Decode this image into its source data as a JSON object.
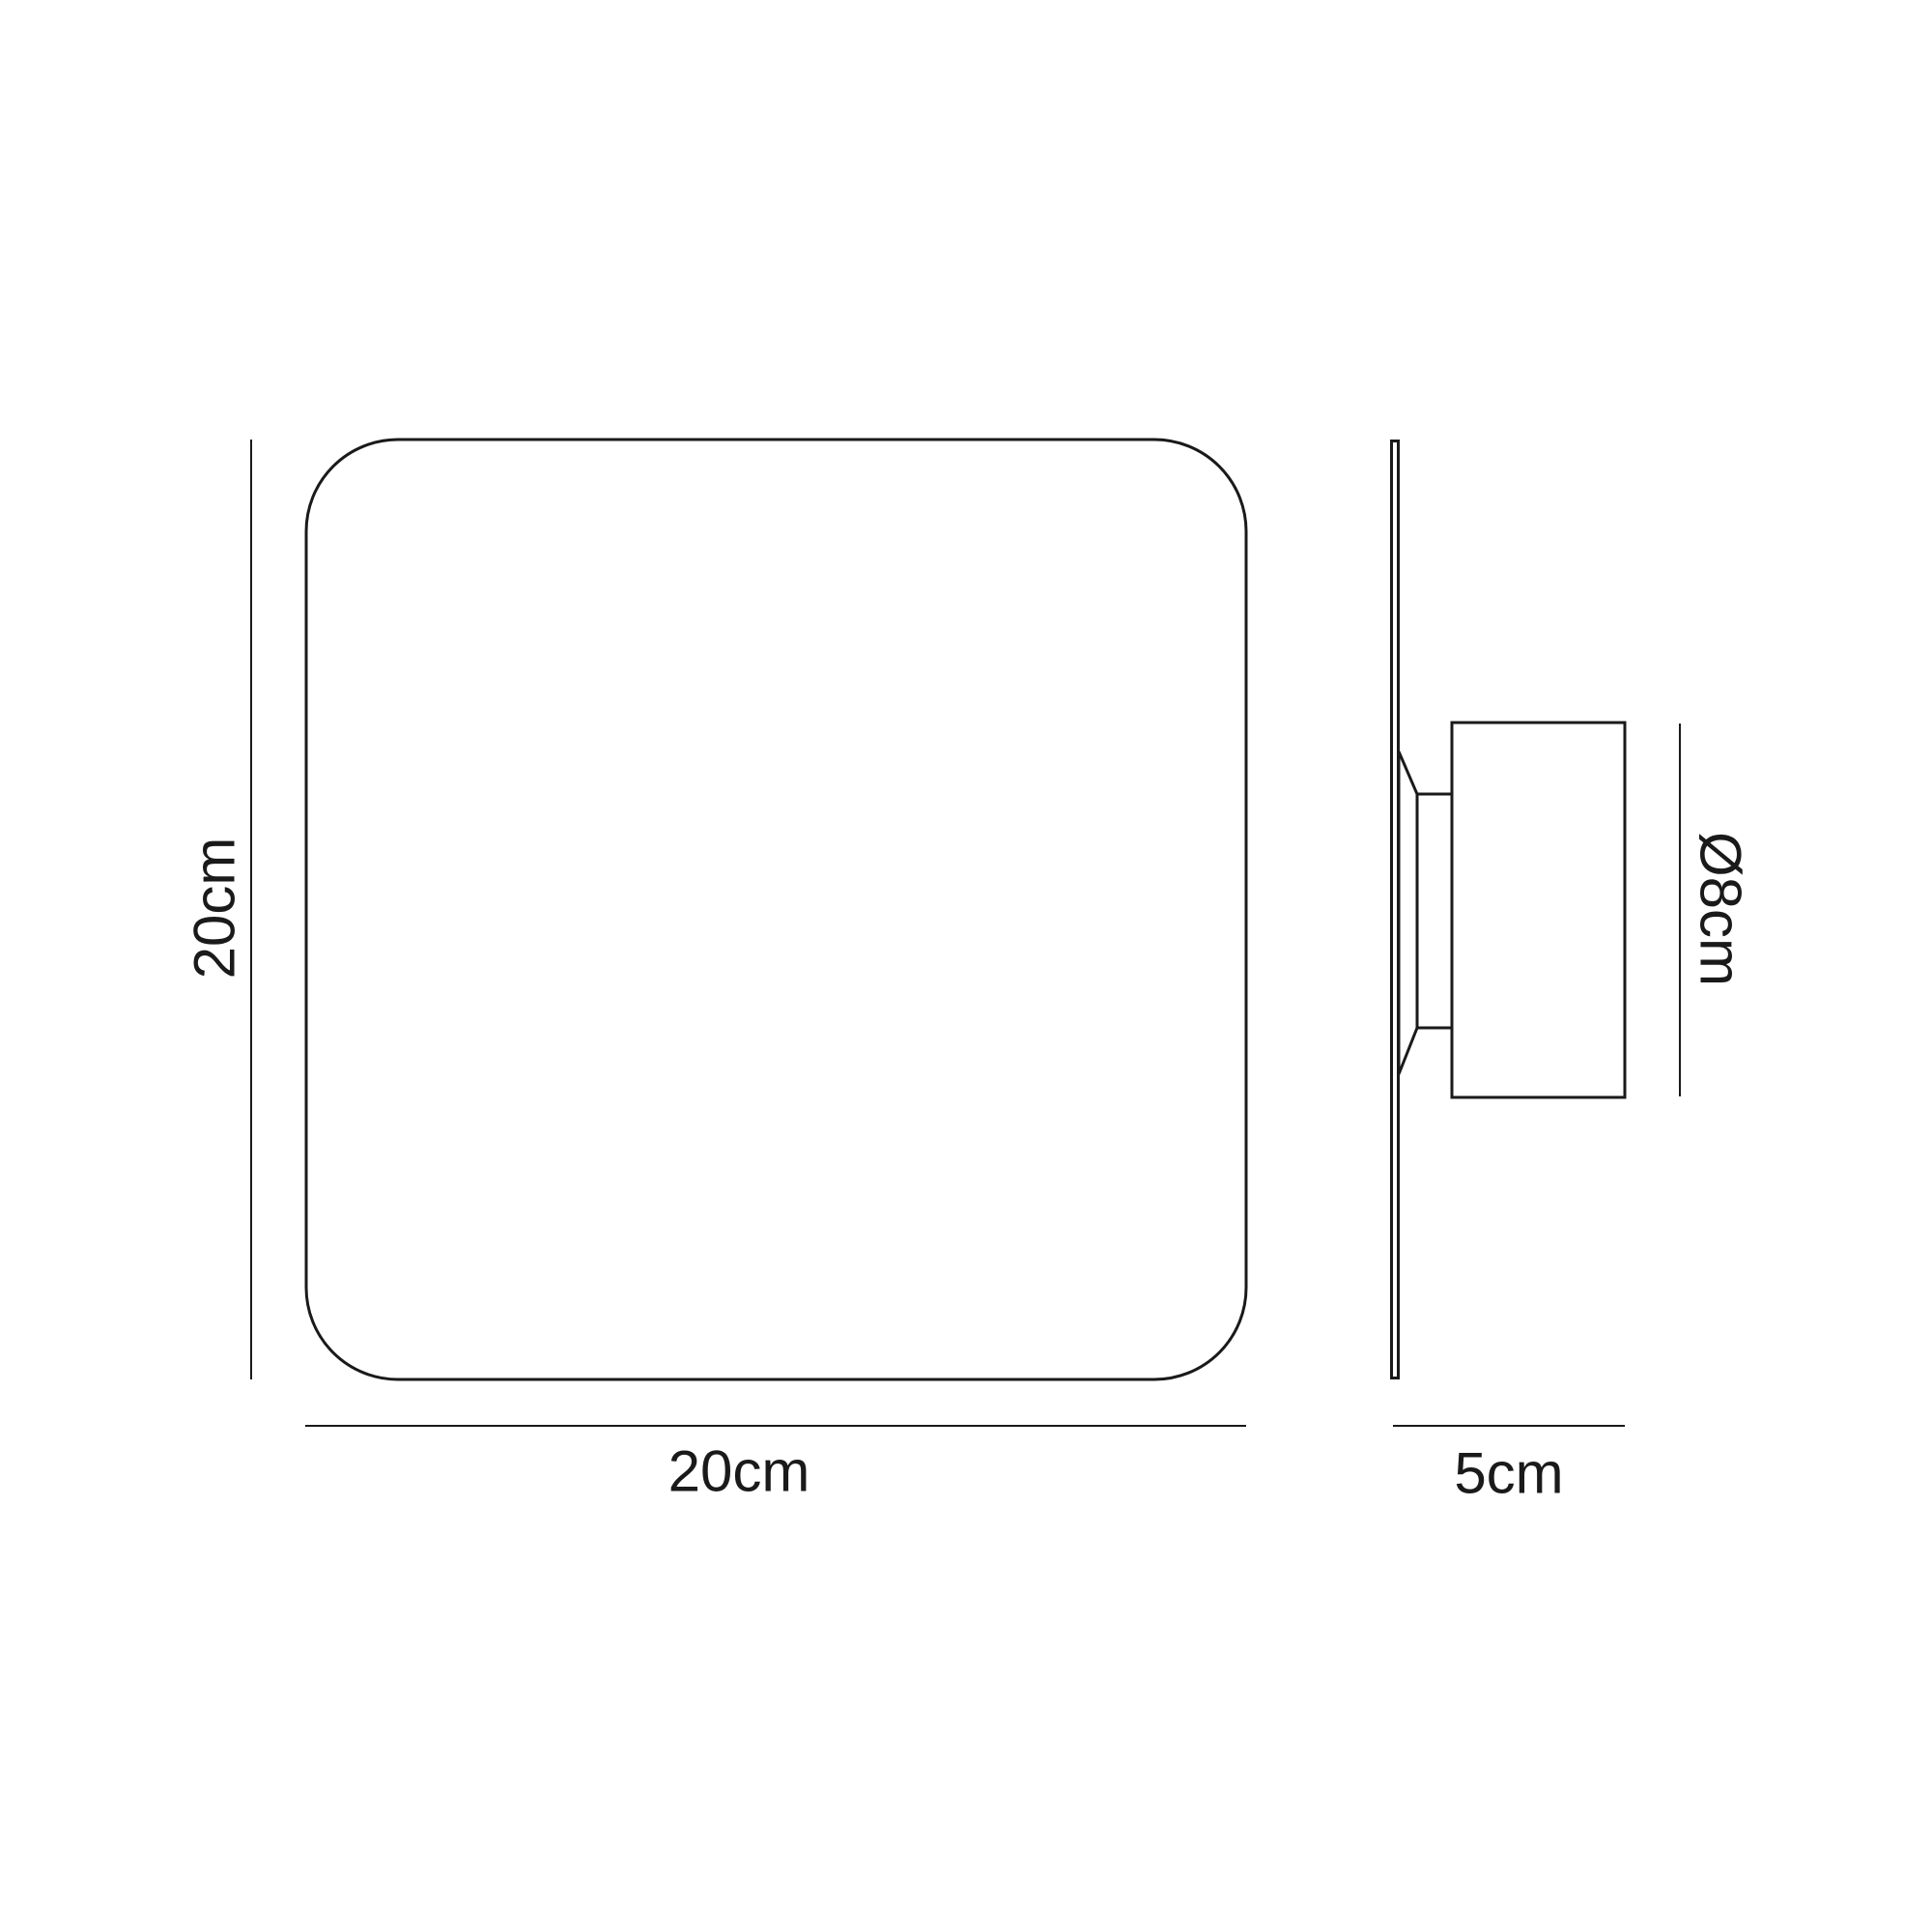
{
  "diagram": {
    "background": "#ffffff",
    "line_color": "#1a1a1a",
    "front_view": {
      "height_label": "20cm",
      "width_label": "20cm"
    },
    "side_view": {
      "diameter_label": "Ø8cm",
      "depth_label": "5cm"
    }
  }
}
